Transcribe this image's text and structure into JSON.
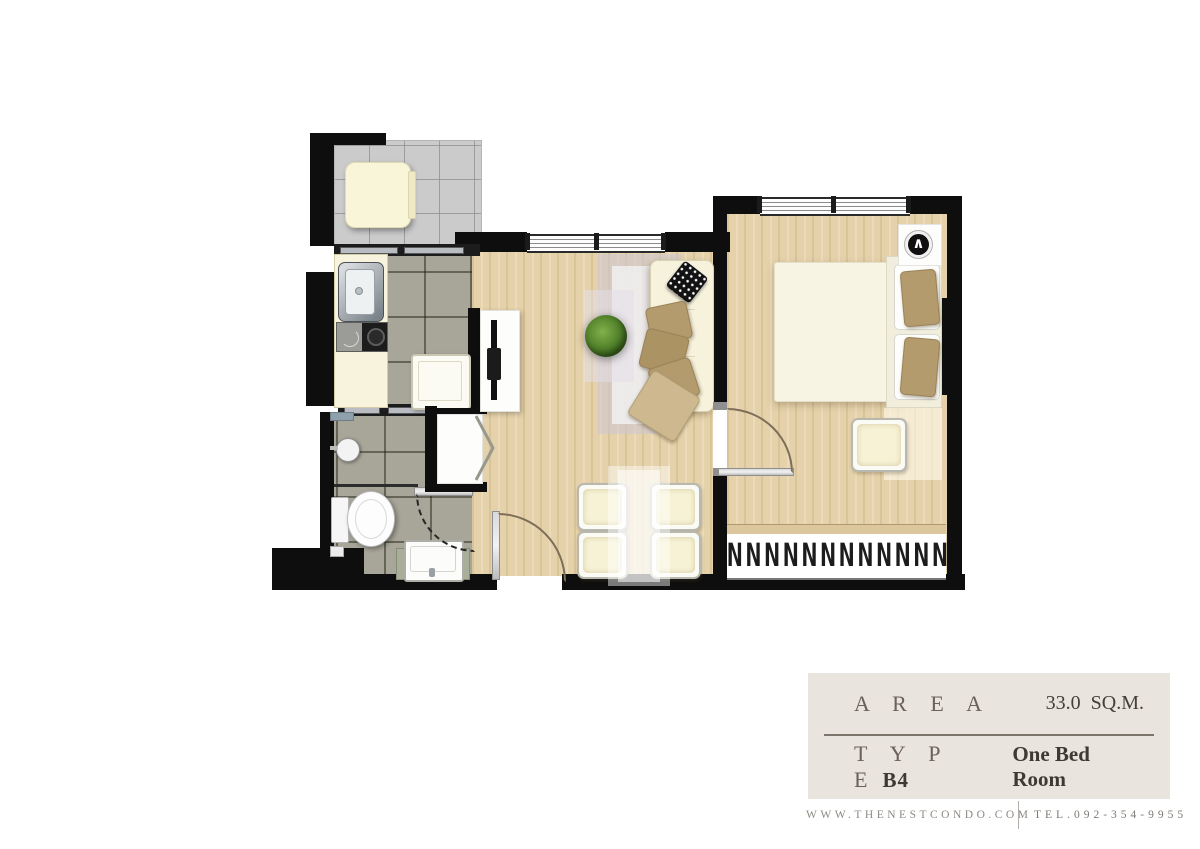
{
  "info_panel": {
    "area_label": "A R E A",
    "area_value": "33.0  SQ.M.",
    "type_label": "T Y P E",
    "type_code": "B4",
    "type_value": "One Bed Room"
  },
  "footer": {
    "website": "WWW.THENESTCONDO.COM",
    "phone": "TEL.092-354-9955"
  },
  "plan": {
    "unit_type": "B4",
    "area_sqm": 33.0,
    "rooms": [
      "balcony",
      "kitchen",
      "bathroom",
      "living-dining",
      "bedroom"
    ],
    "wardrobe_hangers": "NNNNNNNNNNNN",
    "lamp_glyph": "∧"
  },
  "colors": {
    "wall": "#0e0e0e",
    "wood_floor": "#e6d2aa",
    "wet_tile": "#a8a699",
    "balcony_tile": "#cbcbcb",
    "furniture_cream": "#f7f3dc",
    "pillow_tan": "#b39b6e",
    "panel_bg": "#e9e4dd",
    "text_dark": "#3e3933",
    "text_muted": "#8d8983"
  }
}
